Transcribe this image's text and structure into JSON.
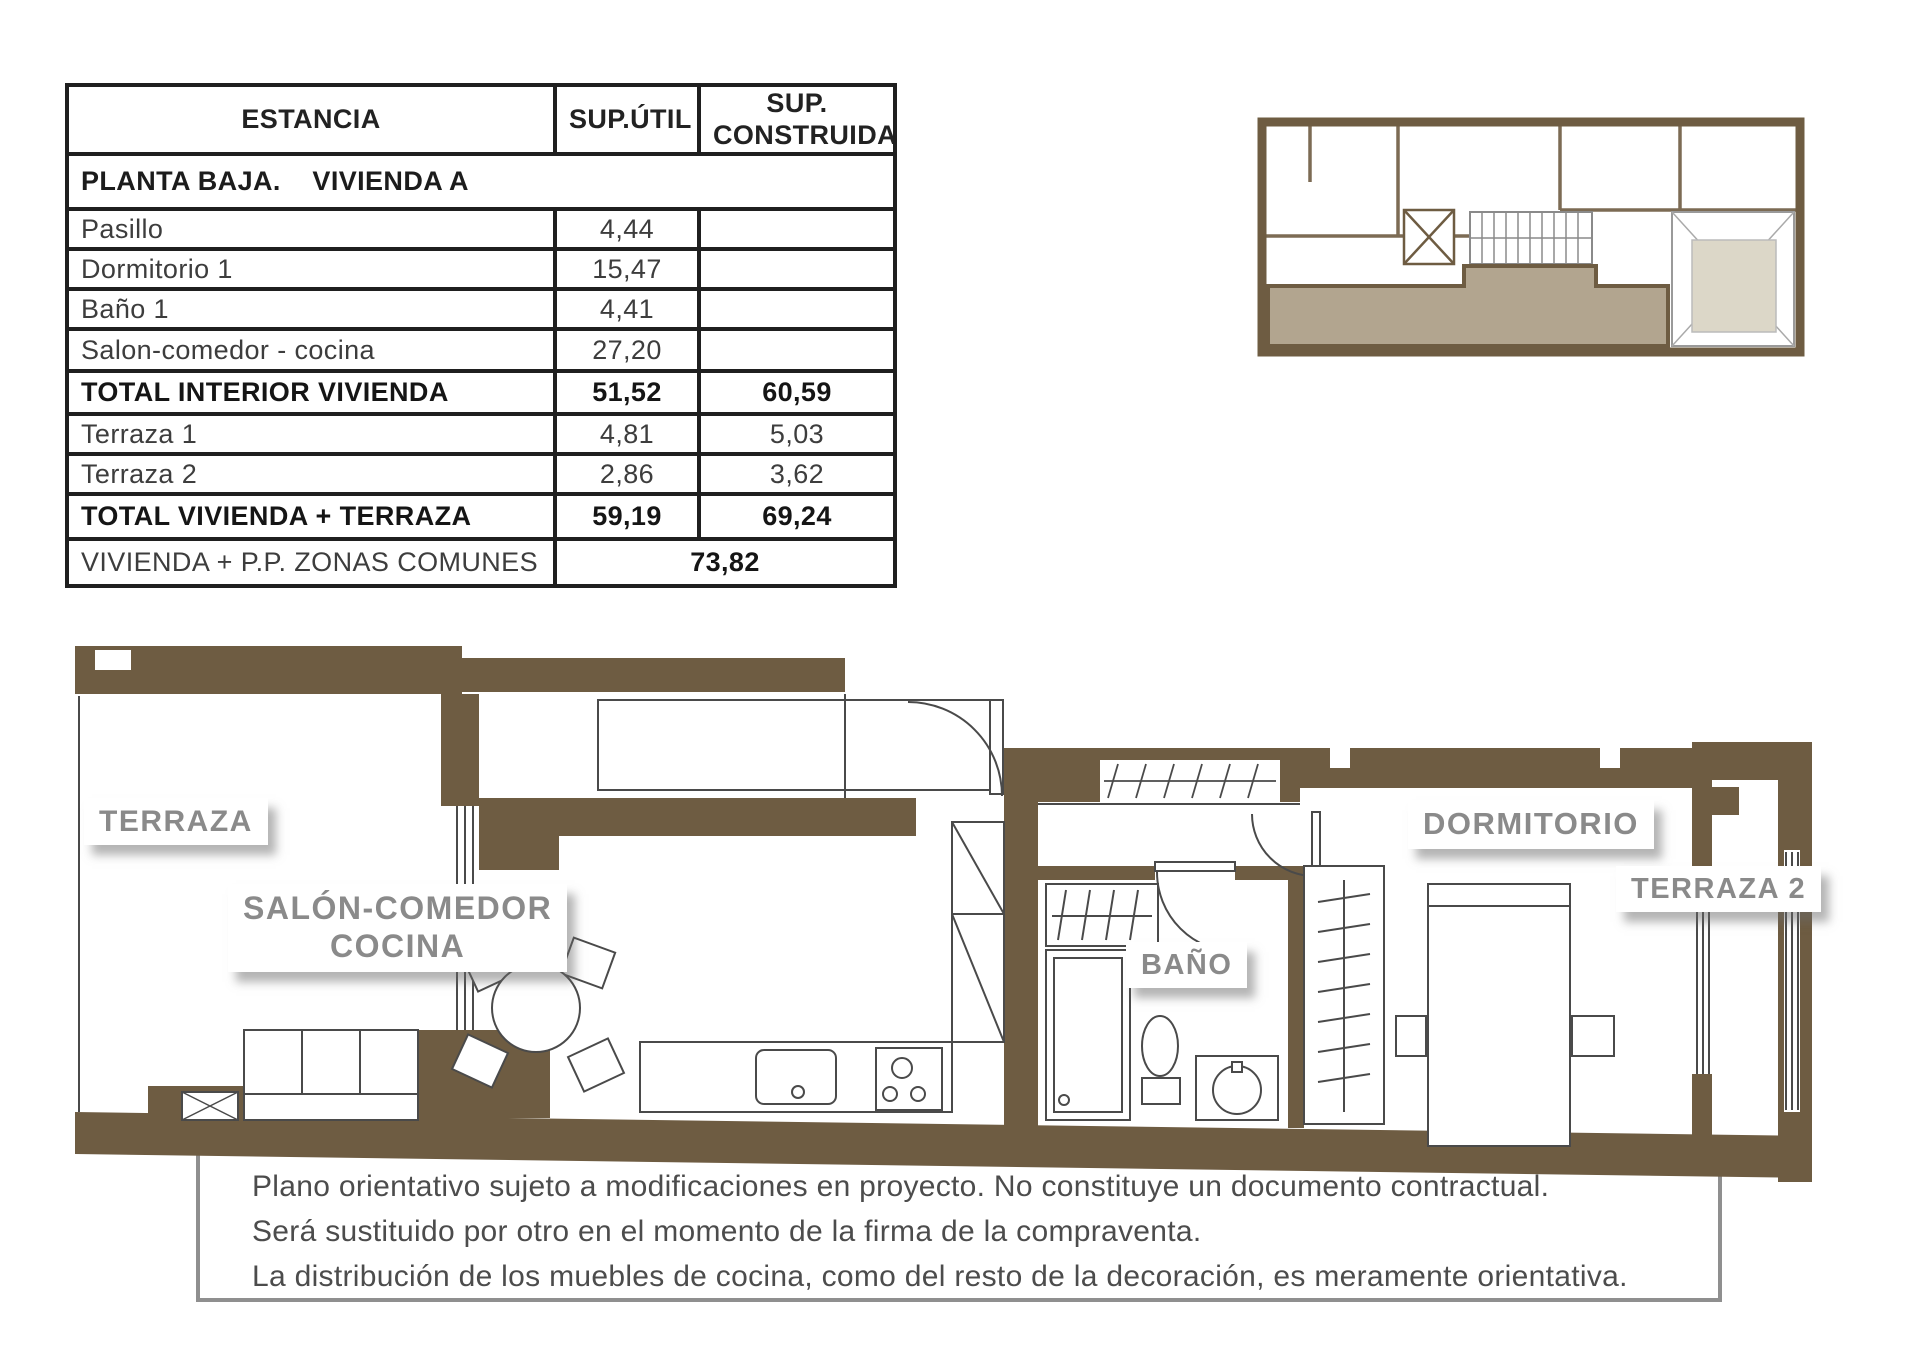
{
  "table": {
    "headers": [
      "ESTANCIA",
      "SUP.ÚTIL",
      "SUP. CONSTRUIDA"
    ],
    "section_title": "PLANTA BAJA.    VIVIENDA A",
    "rows": [
      {
        "name": "Pasillo",
        "util": "4,44",
        "construida": ""
      },
      {
        "name": "Dormitorio 1",
        "util": "15,47",
        "construida": ""
      },
      {
        "name": "Baño 1",
        "util": "4,41",
        "construida": ""
      },
      {
        "name": "Salon-comedor - cocina",
        "util": "27,20",
        "construida": ""
      },
      {
        "name": "TOTAL INTERIOR VIVIENDA",
        "util": "51,52",
        "construida": "60,59"
      },
      {
        "name": "Terraza 1",
        "util": "4,81",
        "construida": "5,03"
      },
      {
        "name": "Terraza 2",
        "util": "2,86",
        "construida": "3,62"
      },
      {
        "name": "TOTAL VIVIENDA + TERRAZA",
        "util": "59,19",
        "construida": "69,24"
      }
    ],
    "footer": {
      "name": "VIVIENDA + P.P. ZONAS COMUNES",
      "value": "73,82"
    }
  },
  "plan_labels": {
    "terraza": "TERRAZA",
    "salon_line1": "SALÓN-COMEDOR",
    "salon_line2": "COCINA",
    "bano": "BAÑO",
    "dormitorio": "DORMITORIO",
    "terraza2": "TERRAZA 2"
  },
  "disclaimer": {
    "line1": "Plano orientativo sujeto a modificaciones en proyecto. No constituye un documento contractual.",
    "line2": "Será sustituido por otro en el momento de la firma de la compraventa.",
    "line3": "La distribución de los muebles de cocina, como del resto de la decoración, es meramente orientativa."
  },
  "colors": {
    "wall_brown": "#6e5c42",
    "unit_highlight": "#b2a58f",
    "patio_fill": "#dcd7c8",
    "label_gray": "#8a8a8a",
    "table_border": "#1f1f1f"
  }
}
